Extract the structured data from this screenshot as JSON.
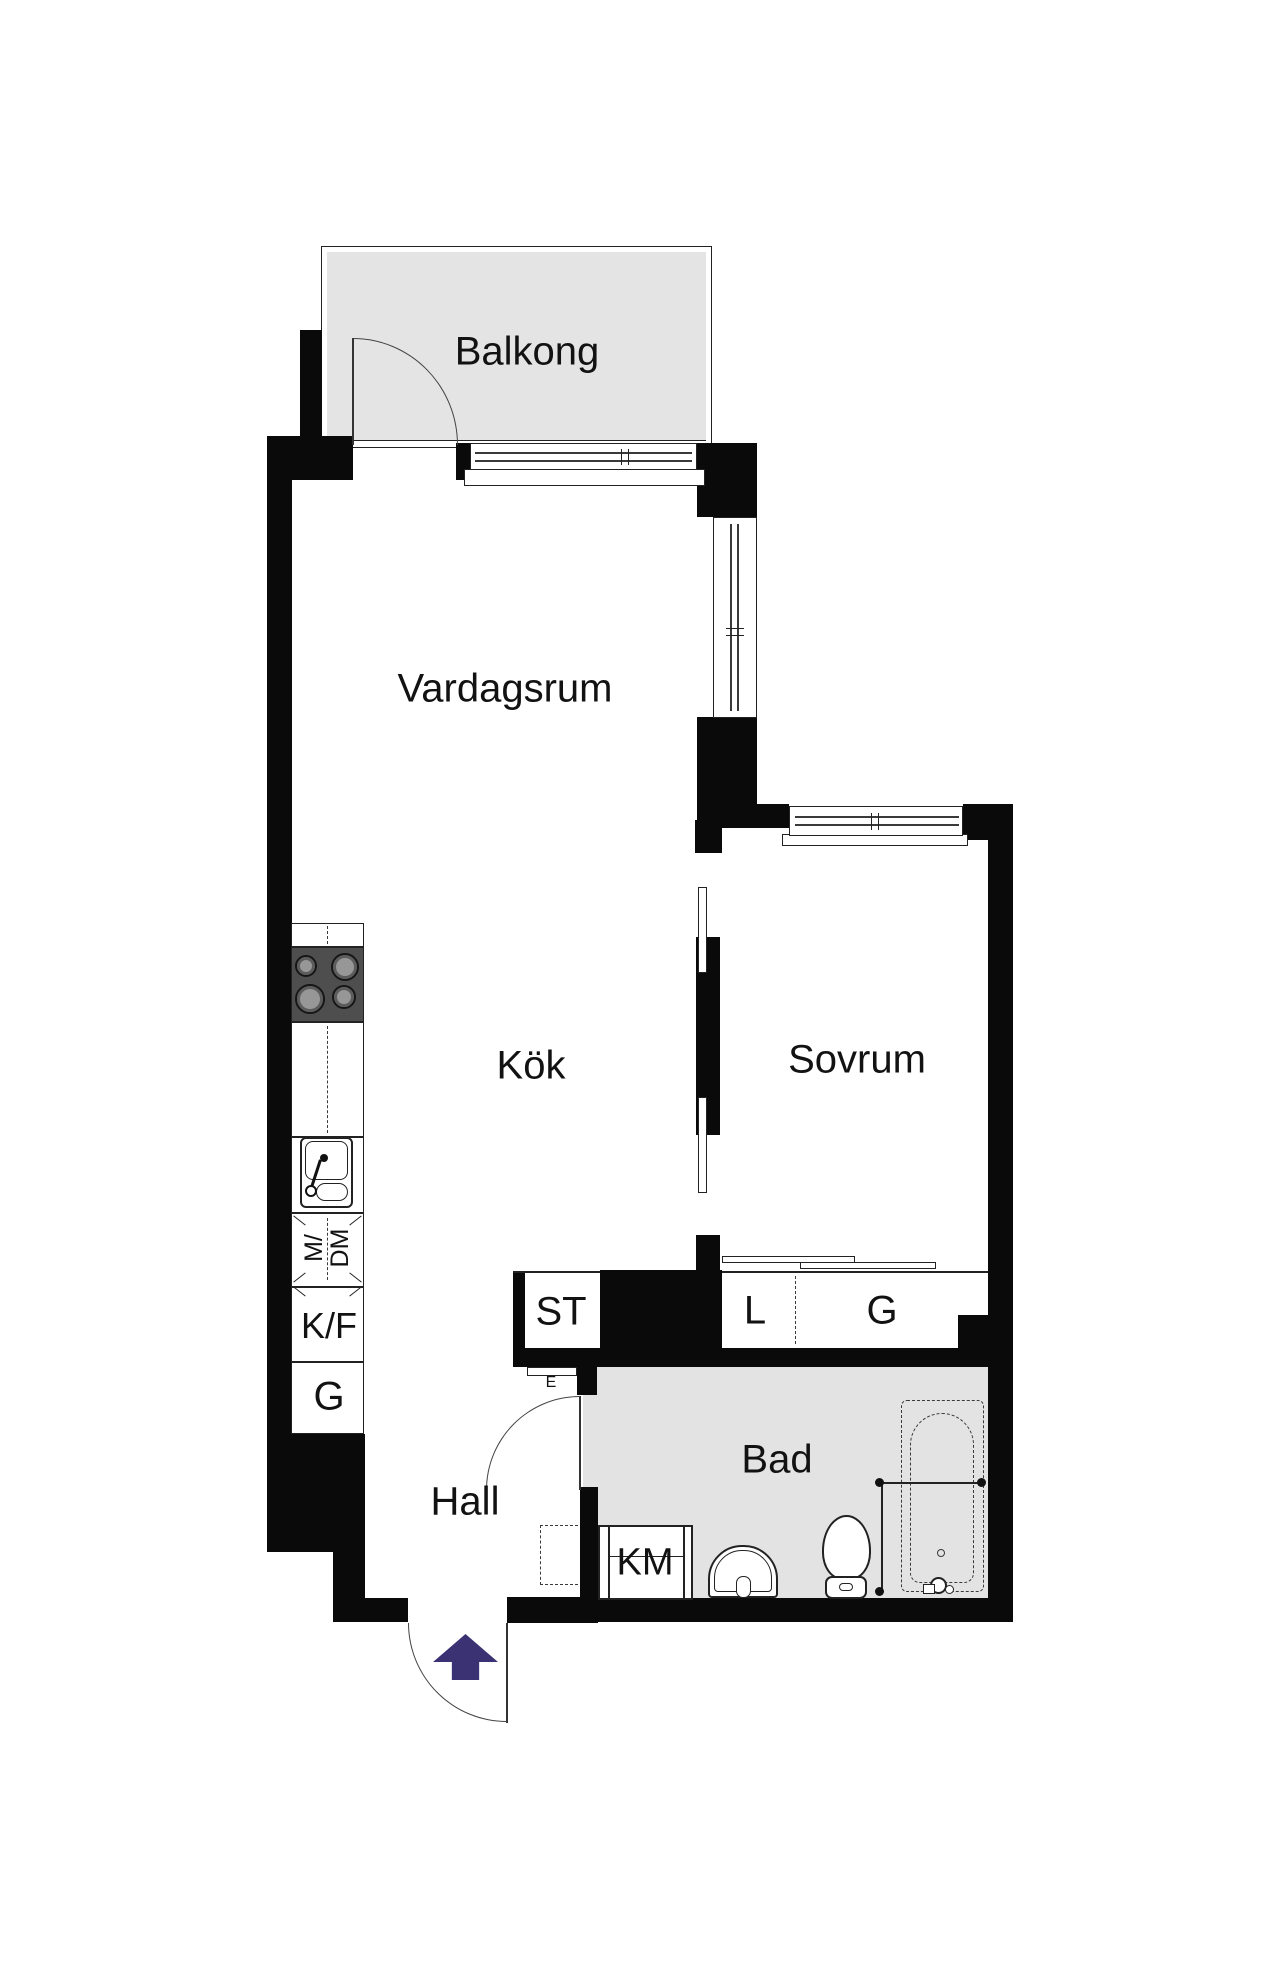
{
  "plan_title": "Apartment floor plan",
  "rooms": {
    "balcony": {
      "label": "Balkong"
    },
    "living": {
      "label": "Vardagsrum"
    },
    "kitchen": {
      "label": "Kök"
    },
    "bedroom": {
      "label": "Sovrum"
    },
    "hall": {
      "label": "Hall"
    },
    "bathroom": {
      "label": "Bad"
    }
  },
  "closets": {
    "st": {
      "label": "ST"
    },
    "linen": {
      "label": "L"
    },
    "wardrobe": {
      "label": "G"
    }
  },
  "kitchen_units": {
    "fridge_freezer": {
      "label": "K/F"
    },
    "tall_cabinet": {
      "label": "G"
    },
    "micro_dishwasher": {
      "line1": "M/",
      "line2": "DM"
    }
  },
  "bathroom_units": {
    "washing_machine": {
      "label": "KM"
    }
  },
  "electrical": {
    "label": "E"
  },
  "colors": {
    "wall": "#0a0a0a",
    "balcony_floor": "#e4e4e4",
    "bathroom_floor": "#e3e3e3",
    "stove": "#4e4e4e",
    "entry_arrow": "#3b3273",
    "line": "#222222"
  }
}
